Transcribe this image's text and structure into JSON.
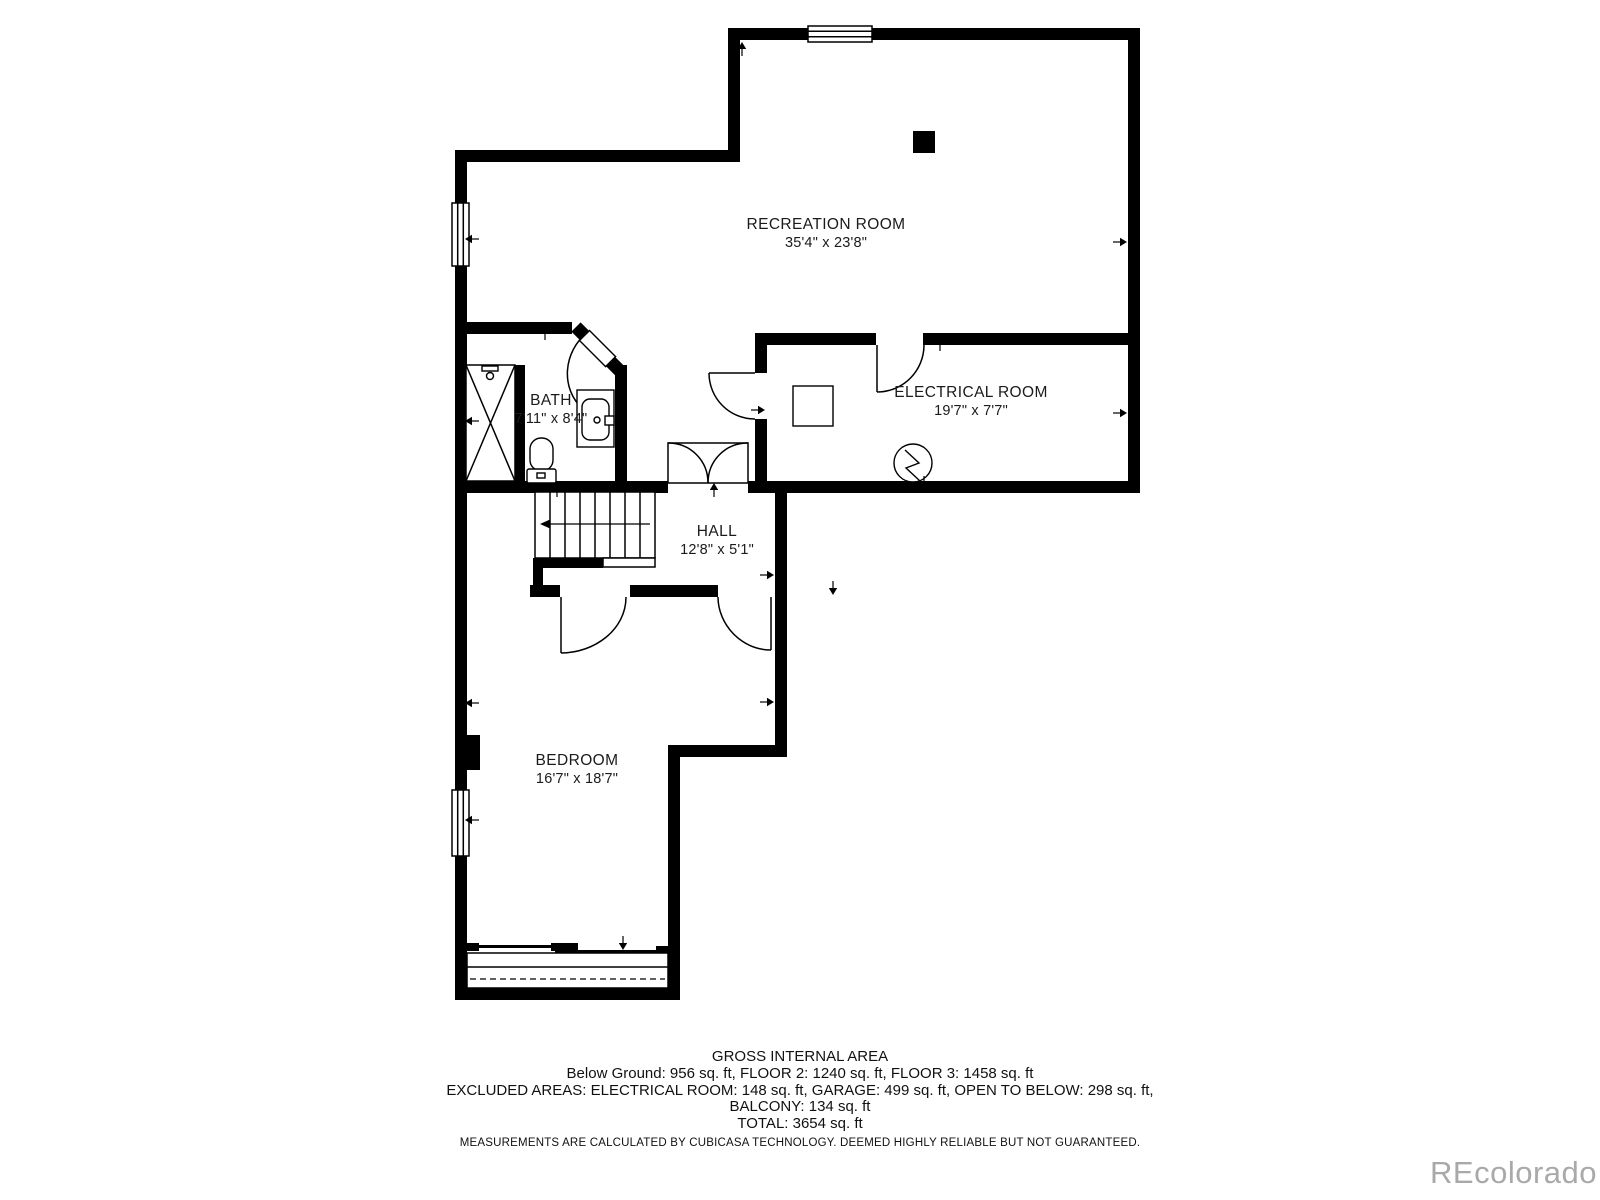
{
  "floor_plan": {
    "rooms": [
      {
        "name": "RECREATION ROOM",
        "dims": "35'4\" x 23'8\""
      },
      {
        "name": "ELECTRICAL ROOM",
        "dims": "19'7\" x 7'7\""
      },
      {
        "name": "BATH",
        "dims": "7'11\" x 8'4\""
      },
      {
        "name": "HALL",
        "dims": "12'8\" x 5'1\""
      },
      {
        "name": "BEDROOM",
        "dims": "16'7\" x 18'7\""
      }
    ]
  },
  "footer": {
    "title": "GROSS INTERNAL AREA",
    "areas_line": "Below Ground: 956 sq. ft, FLOOR 2: 1240 sq. ft, FLOOR 3: 1458 sq. ft",
    "excluded_line": "EXCLUDED AREAS: ELECTRICAL ROOM: 148 sq. ft, GARAGE: 499 sq. ft, OPEN TO BELOW: 298 sq. ft,",
    "excluded_line2": "BALCONY: 134 sq. ft",
    "total_line": "TOTAL: 3654 sq. ft",
    "disclaimer": "MEASUREMENTS ARE CALCULATED BY CUBICASA TECHNOLOGY. DEEMED HIGHLY RELIABLE BUT NOT GUARANTEED."
  },
  "watermark": "REcolorado",
  "colors": {
    "wall": "#000000",
    "text": "#1c1c1c",
    "watermark": "#a9a9a9",
    "background": "#ffffff"
  }
}
